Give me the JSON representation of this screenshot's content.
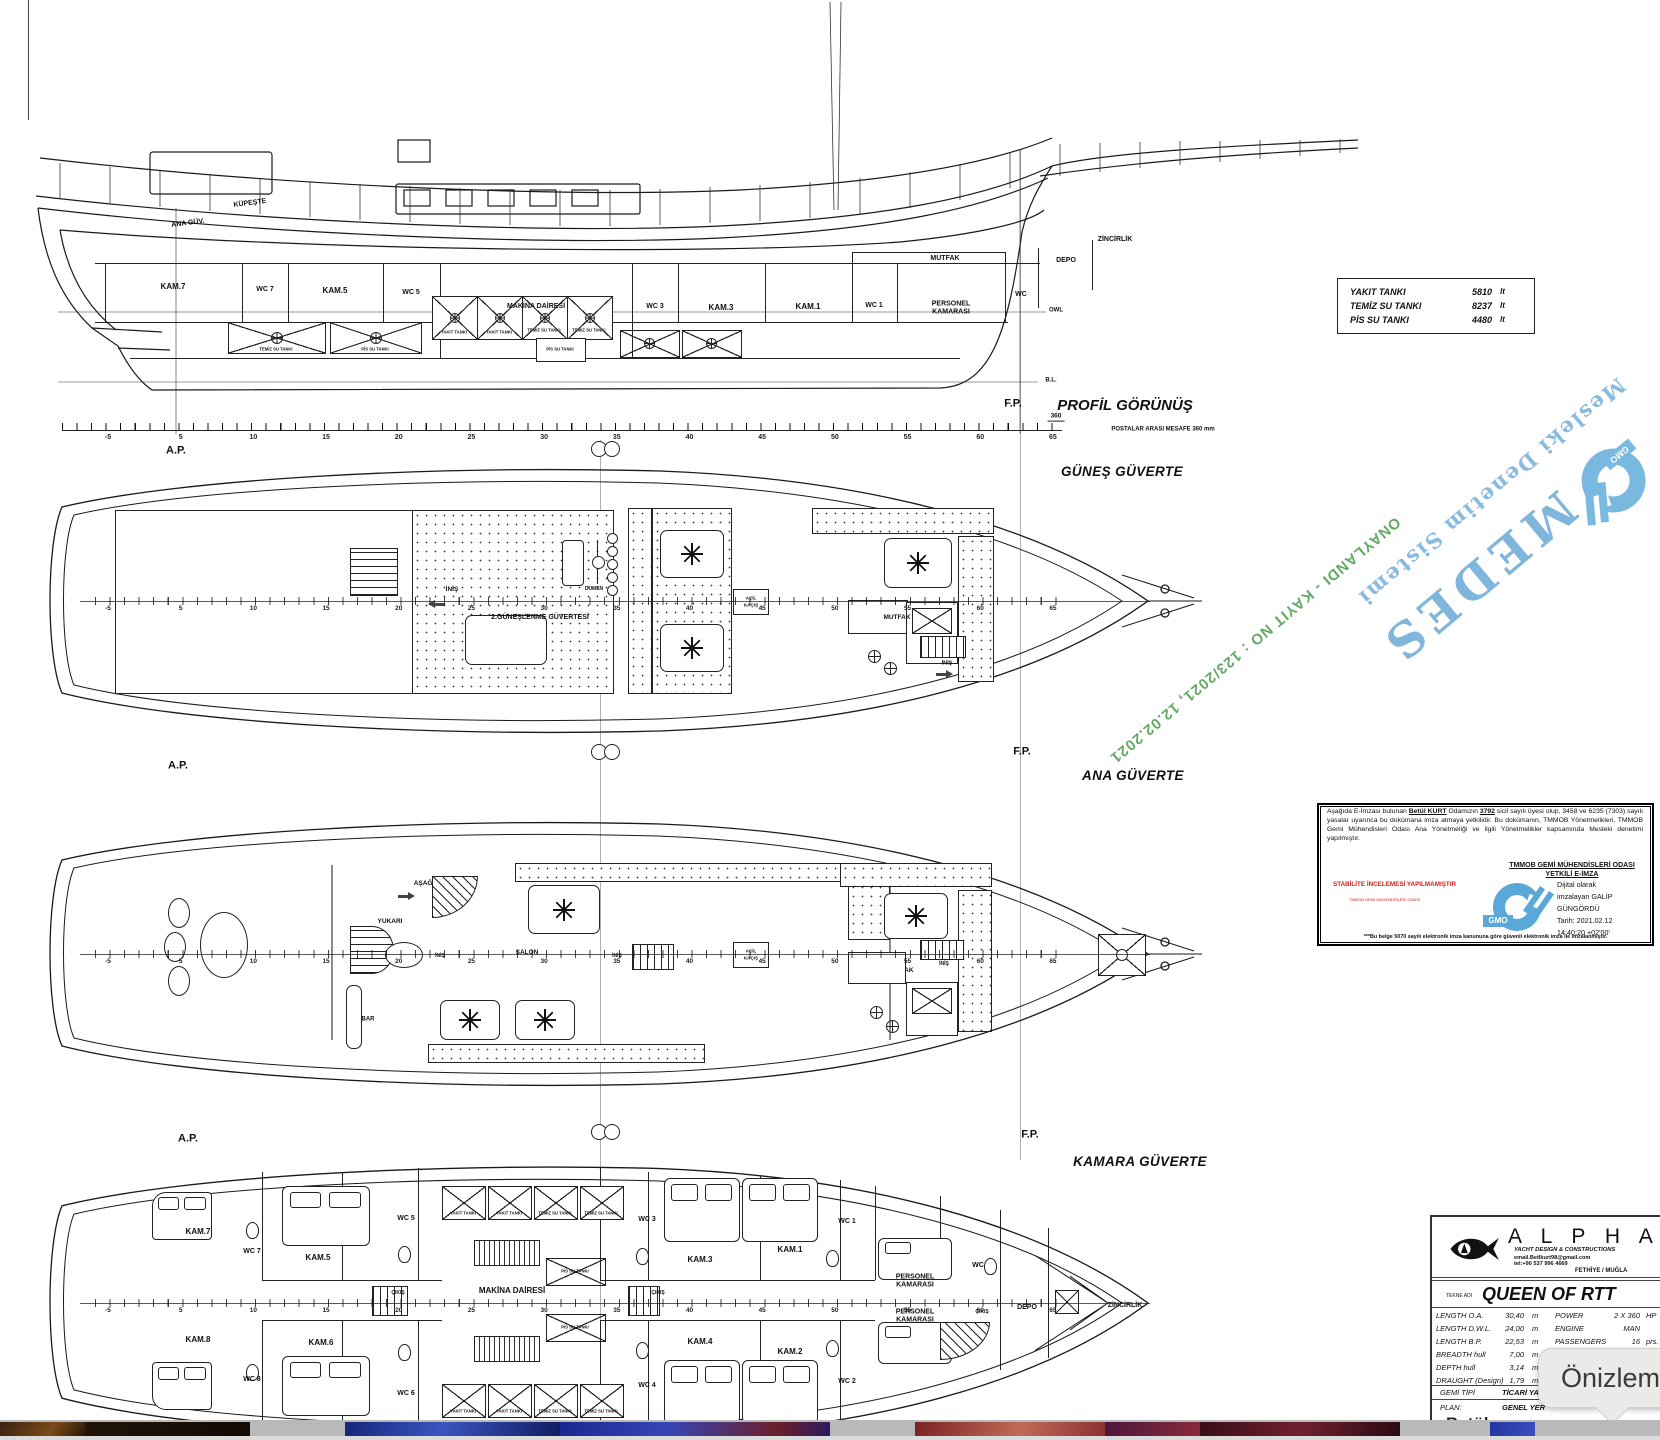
{
  "colors": {
    "watermark_blue": "#74aed9",
    "approval_green": "#4a9a4a",
    "stamp_red": "#cc2222",
    "gmo_blue": "#5aa8d8"
  },
  "ruler": [
    "-5",
    "5",
    "10",
    "15",
    "20",
    "25",
    "30",
    "35",
    "40",
    "45",
    "50",
    "55",
    "60",
    "65"
  ],
  "profile": {
    "title": "PROFİL GÖRÜNÜŞ",
    "spacing_note": "POSTALAR ARASI MESAFE 360 mm",
    "spacing_value": "360",
    "fp": "F.P.",
    "ap": "A.P.",
    "bl": "B.L.",
    "owl": "OWL",
    "kupeste": "KÜPEŞTE",
    "ana_guv": "ANA GÜV.",
    "rooms": [
      "KAM.7",
      "WC 7",
      "KAM.5",
      "WC 5",
      "MAKİNA DAİRESİ",
      "WC 3",
      "KAM.3",
      "KAM.1",
      "WC 1",
      "PERSONEL KAMARASI",
      "MUTFAK",
      "WC",
      "DEPO",
      "ZİNCİRLİK"
    ],
    "tanks": [
      "YAKIT TANKI",
      "YAKIT TANKI",
      "TEMİZ SU TANKI",
      "TEMİZ SU TANKI",
      "PİS SU TANKI",
      "TEMİZ SU TANKI",
      "PİS SU TANKI"
    ]
  },
  "tank_table": {
    "rows": [
      {
        "label": "YAKIT TANKI",
        "value": "5810",
        "unit": "lt"
      },
      {
        "label": "TEMİZ SU TANKI",
        "value": "8237",
        "unit": "lt"
      },
      {
        "label": "PİS SU TANKI",
        "value": "4480",
        "unit": "lt"
      }
    ]
  },
  "sun_deck": {
    "title": "GÜNEŞ GÜVERTE",
    "ap": "A.P.",
    "fp": "F.P.",
    "inis1": "İNİŞ",
    "dumen": "DÜMEN",
    "sunbathing": "2.GÜNEŞLENME GÜVERTESİ",
    "acil1": "AÇİL",
    "acil2": "KAÇIŞ",
    "mutfak": "MUTFAK",
    "inis2": "İNİŞ"
  },
  "main_deck": {
    "title": "ANA GÜVERTE",
    "ap": "A.P.",
    "fp": "F.P.",
    "asagi": "AŞAĞI",
    "yukari": "YUKARI",
    "salon": "SALON",
    "bar": "BAR",
    "inis1": "İNİŞ",
    "inis2": "İNİŞ",
    "acil1": "AÇİL",
    "acil2": "KAÇIŞ",
    "mutfak": "MUTFAK",
    "inis3": "İNİŞ"
  },
  "cabin_deck": {
    "title": "KAMARA GÜVERTE",
    "ap": "A.P.",
    "fp": "F.P.",
    "rooms": [
      "KAM.7",
      "WC 7",
      "KAM.5",
      "WC 5",
      "KAM.8",
      "KAM.6",
      "WC 8",
      "WC 6",
      "MAKİNA DAİRESİ",
      "WC 3",
      "KAM.3",
      "KAM.1",
      "WC 1",
      "KAM.4",
      "KAM.2",
      "WC 4",
      "WC 2",
      "PERSONEL KAMARASI",
      "PERSONEL KAMARASI",
      "WC",
      "DEPO",
      "ZİNCİRLİK"
    ],
    "tanks_top": [
      "YAKIT TANKI",
      "YAKIT TANKI",
      "TEMİZ SU TANKI",
      "TEMİZ SU TANKI"
    ],
    "tanks_mid": [
      "PİS SU TANKI",
      "PİS SU TANKI"
    ],
    "tanks_bottom": [
      "YAKIT TANKI",
      "YAKIT TANKI",
      "TEMİZ SU TANKI",
      "TEMİZ SU TANKI"
    ],
    "cikis": [
      "ÇIKIŞ",
      "ÇIKIŞ",
      "ÇIKIŞ"
    ]
  },
  "watermark": {
    "medes": "MEDES",
    "subtitle": "Mesleki Denetim Sistemi",
    "approval": "ONAYLANDI - KAYIT NO : 123/2021, 12.02.2021",
    "gmo": "GMO"
  },
  "stamp": {
    "p1": "Aşağıda E-İmzası bulunan ",
    "name": "Betül KURT",
    "p2": " Odamızın ",
    "reg": "3792",
    "p3": " sicil sayılı üyesi olup, 3458 ve 6235 (7303) sayılı yasalar uyarınca bu dokümana imza atmaya yetkilidir. Bu dokümanın, TMMOB Yönetmelikleri, TMMOB Gemi Mühendisleri Odası Ana Yönetmeliği ve ilgili Yönetmelikler kapsamında Mesleki denetimi yapılmıştır.",
    "office1": "TMMOB GEMİ MÜHENDİSLERİ ODASI",
    "office2": "YETKİLİ E-İMZA",
    "red1": "STABİLİTE İNCELEMESİ YAPILMAMIŞTIR",
    "red2": "TMMOB GEMİ MÜHENDİSLERİ ODASI",
    "gmo": "GMO",
    "sig1": "Dijital olarak",
    "sig2": "imzalayan GALİP",
    "sig3": "GÜNGÖRDÜ",
    "sig4": "Tarih: 2021.02.12",
    "sig5": "14:40:20 +02'00'",
    "foot": "***Bu belge 5070 sayılı elektronik imza kanununa göre güvenli elektronik imza ile imzalanmıştır."
  },
  "title_block": {
    "brand": "A L P H A",
    "tagline": "YACHT DESIGN & CONSTRUCTIONS",
    "email": "email.Betlkurt98@gmail.com",
    "tel": "tel:+90 537 996 4669",
    "city": "FETHİYE / MUĞLA",
    "name_label": "TEKNE ADI",
    "boat_name": "QUEEN OF RTT",
    "specs_left": [
      {
        "k": "LENGTH  O.A.",
        "v": "30,40",
        "u": "m"
      },
      {
        "k": "LENGTH  D.W.L.",
        "v": "24,00",
        "u": "m"
      },
      {
        "k": "LENGTH  B.P.",
        "v": "22,53",
        "u": "m"
      },
      {
        "k": "BREADTH hull",
        "v": "7,00",
        "u": "m"
      },
      {
        "k": "DEPTH hull",
        "v": "3,14",
        "u": "m"
      },
      {
        "k": "DRAUGHT (Design)",
        "v": "1,79",
        "u": "m"
      }
    ],
    "specs_right": [
      {
        "k": "POWER",
        "v": "2 X  360",
        "u": "HP"
      },
      {
        "k": "ENGINE",
        "v": "MAN",
        "u": ""
      },
      {
        "k": "PASSENGERS",
        "v": "16",
        "u": "prs."
      },
      {
        "k": "CREWS",
        "v": "3",
        "u": "prs."
      },
      {
        "k": "SPEED (Design)",
        "v": "11,44",
        "u": "knt"
      }
    ],
    "type_label": "GEMİ TİPİ",
    "type_value": "TİCARİ YAT",
    "plan_label": "PLAN:",
    "plan_value": "GENEL YER",
    "partial_signature": "Betül"
  },
  "tooltip": {
    "text": "Önizlem"
  }
}
